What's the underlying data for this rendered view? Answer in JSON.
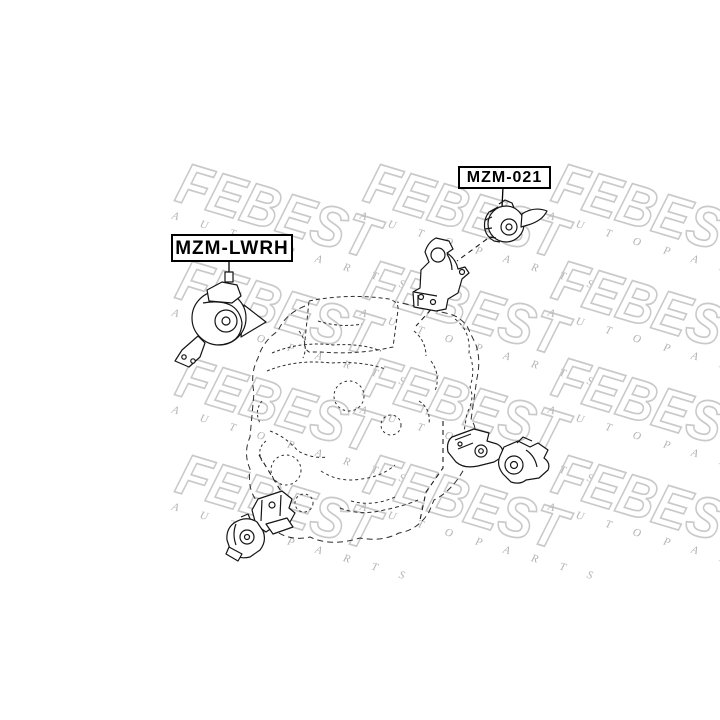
{
  "watermark": {
    "brand": "FEBEST",
    "auto": "A U T O",
    "parts": "P A R T S",
    "outline_color": "#c9c9c9",
    "sub_color": "#b3b3b3"
  },
  "labels": {
    "mzm021": {
      "text": "MZM-021"
    },
    "mzmlwrh": {
      "text": "MZM-LWRH"
    }
  },
  "diagram": {
    "background": "#ffffff",
    "ink_color": "#151515",
    "sketch_color": "#2e2e2e"
  }
}
